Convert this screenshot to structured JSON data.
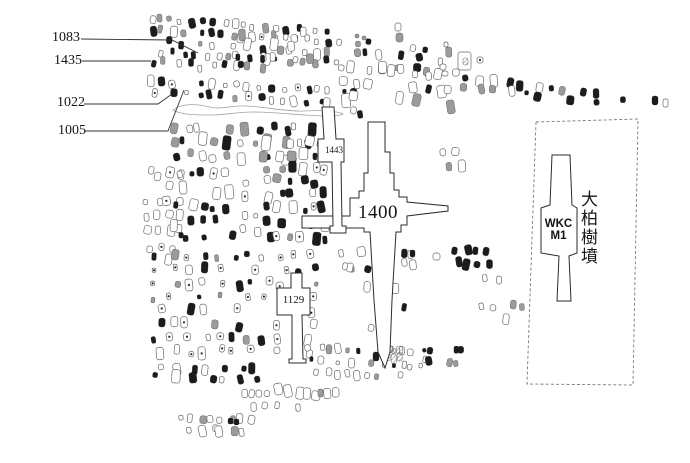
{
  "figure": {
    "type": "archaeological-cemetery-plan",
    "background": "#ffffff"
  },
  "labels": {
    "m1083": "1083",
    "m1435": "1435",
    "m1022": "1022",
    "m1005": "1005",
    "m1443": "1443",
    "m1400": "1400",
    "m1129": "1129",
    "wkc_line1": "WKC",
    "wkc_line2": "M1",
    "site_name": "大柏樹墳"
  },
  "colors": {
    "ink": "#1c1c1c",
    "open_stroke": "#686868",
    "gray_fill": "#9b9b9b",
    "hatch_stroke": "#777777",
    "tomb_stroke": "#2b2b2b",
    "leader": "#333333",
    "enclosure_dash": "#7a7a7a",
    "ditch": "#a3a3a3",
    "background": "#ffffff"
  },
  "geometry": {
    "tombs": [
      {
        "id": "1400",
        "points": "368,122 385,122 385,152 390,152 390,173 394,173 394,190 399,190 399,197 407,197 407,202 448,206 448,211 407,216 407,225 401,225 401,232 396,232 392,300 390,352 385,368 378,352 374,300 370,232 364,232 364,228 302,228 302,216 350,216 350,198 359,198 359,191 364,191 364,173 368,173"
      },
      {
        "id": "1443",
        "points": "322,107 334,107 336,139 344,139 344,162 341,162 342,226 346,226 346,233 330,233 330,226 333,226 332,162 318,162 318,139 324,139"
      },
      {
        "id": "1129",
        "points": "291,273 302,273 302,288 310,288 310,315 302,315 303,359 306,359 306,363 289,363 289,359 292,359 292,315 277,315 277,288 291,288"
      },
      {
        "id": "wkc-m1",
        "points": "552,155 570,155 572,205 577,208 577,253 569,256 571,301 557,301 559,256 541,253 541,208 550,205"
      }
    ],
    "enclosure": {
      "points": "536,122 638,119 633,385 527,384"
    },
    "leaders": [
      {
        "id": "1083",
        "points": "81,39 172,40 198,53"
      },
      {
        "id": "1435",
        "points": "82,61 151,61"
      },
      {
        "id": "1022",
        "points": "84,104 158,104 172,94"
      },
      {
        "id": "1005",
        "points": "85,131 168,131 184,90"
      }
    ],
    "ditch_path": "M173,110 C180,104 194,103 210,107 C221,110 231,105 247,106 C267,107 287,112 305,111 C321,110 337,111 343,114 C337,117 321,116 305,115 C289,114 271,112 253,112 C237,112 225,115 211,115 C197,115 181,115 173,110 Z",
    "scatter_regions": [
      {
        "id": "top-row-1",
        "x": 146,
        "y": 14,
        "w": 186,
        "h": 20,
        "rows": 2,
        "n": 18,
        "angle": 4,
        "skip": 0.08,
        "styles": {
          "solid": 0.32,
          "open": 0.38,
          "gray": 0.2,
          "dotted": 0.1
        },
        "sz": [
          3.5,
          7
        ]
      },
      {
        "id": "top-row-2",
        "x": 150,
        "y": 36,
        "w": 175,
        "h": 20,
        "rows": 2,
        "n": 13,
        "angle": 4,
        "skip": 0.15,
        "styles": {
          "solid": 0.35,
          "open": 0.45,
          "gray": 0.2
        },
        "sz": [
          3.5,
          7
        ]
      },
      {
        "id": "top-right-rows",
        "x": 238,
        "y": 27,
        "w": 215,
        "h": 32,
        "rows": 3,
        "n": 14,
        "angle": 5,
        "skip": 0.2,
        "styles": {
          "solid": 0.18,
          "open": 0.62,
          "gray": 0.2
        },
        "sz": [
          4,
          8
        ]
      },
      {
        "id": "row-1435",
        "x": 148,
        "y": 55,
        "w": 92,
        "h": 14,
        "rows": 1,
        "n": 8,
        "angle": 4,
        "skip": 0.12,
        "styles": {
          "solid": 0.5,
          "open": 0.4,
          "gray": 0.1
        },
        "sz": [
          3.5,
          7
        ]
      },
      {
        "id": "dark-cluster-mid",
        "x": 222,
        "y": 53,
        "w": 46,
        "h": 16,
        "rows": 2,
        "n": 4,
        "angle": 3,
        "skip": 0.1,
        "styles": {
          "solid": 0.75,
          "gray": 0.25
        },
        "sz": [
          4,
          7
        ]
      },
      {
        "id": "dense-row-1005",
        "x": 146,
        "y": 76,
        "w": 214,
        "h": 22,
        "rows": 2,
        "n": 18,
        "angle": 3,
        "skip": 0.08,
        "styles": {
          "solid": 0.45,
          "open": 0.3,
          "gray": 0.15,
          "dotted": 0.1
        },
        "sz": [
          3.5,
          7
        ]
      },
      {
        "id": "open-rows-right",
        "x": 336,
        "y": 60,
        "w": 122,
        "h": 44,
        "rows": 3,
        "n": 10,
        "angle": 4,
        "skip": 0.2,
        "styles": {
          "solid": 0.08,
          "open": 0.77,
          "gray": 0.15
        },
        "sz": [
          4.5,
          9
        ]
      },
      {
        "id": "far-east-row",
        "x": 458,
        "y": 74,
        "w": 186,
        "h": 16,
        "rows": 2,
        "n": 13,
        "angle": 7,
        "skip": 0.22,
        "styles": {
          "solid": 0.55,
          "open": 0.25,
          "gray": 0.2
        },
        "sz": [
          4,
          8
        ]
      },
      {
        "id": "field-top",
        "x": 166,
        "y": 120,
        "w": 152,
        "h": 42,
        "rows": 3,
        "n": 11,
        "angle": 1,
        "skip": 0.15,
        "styles": {
          "solid": 0.5,
          "open": 0.3,
          "gray": 0.2
        },
        "sz": [
          4,
          8.5
        ]
      },
      {
        "id": "rounded-cluster",
        "x": 258,
        "y": 137,
        "w": 72,
        "h": 25,
        "rows": 2,
        "n": 5,
        "angle": 0,
        "skip": 0.15,
        "styles": {
          "open": 0.8,
          "gray": 0.2
        },
        "sz": [
          6,
          10
        ]
      },
      {
        "id": "left-light-column",
        "x": 143,
        "y": 166,
        "w": 42,
        "h": 102,
        "rows": 7,
        "n": 4,
        "angle": 0,
        "skip": 0.2,
        "styles": {
          "open": 0.85,
          "dotted": 0.15
        },
        "sz": [
          4.5,
          8.5
        ]
      },
      {
        "id": "field-mid-left",
        "x": 170,
        "y": 166,
        "w": 66,
        "h": 80,
        "rows": 5,
        "n": 5,
        "angle": 0,
        "skip": 0.12,
        "styles": {
          "solid": 0.5,
          "open": 0.25,
          "dotted": 0.15,
          "gray": 0.1
        },
        "sz": [
          4,
          8.5
        ]
      },
      {
        "id": "field-mid-gap",
        "x": 240,
        "y": 172,
        "w": 20,
        "h": 68,
        "rows": 4,
        "n": 2,
        "angle": 0,
        "skip": 0.3,
        "styles": {
          "open": 0.8,
          "dotted": 0.2
        },
        "sz": [
          4,
          7
        ]
      },
      {
        "id": "field-mid-right",
        "x": 262,
        "y": 160,
        "w": 68,
        "h": 84,
        "rows": 6,
        "n": 6,
        "angle": 0,
        "skip": 0.15,
        "styles": {
          "solid": 0.5,
          "open": 0.25,
          "dotted": 0.15,
          "gray": 0.1
        },
        "sz": [
          4,
          8.5
        ]
      },
      {
        "id": "field-lower",
        "x": 150,
        "y": 250,
        "w": 170,
        "h": 108,
        "rows": 8,
        "n": 11,
        "angle": 0,
        "skip": 0.15,
        "styles": {
          "solid": 0.3,
          "open": 0.2,
          "dotted": 0.4,
          "gray": 0.1
        },
        "sz": [
          3.5,
          7.5
        ]
      },
      {
        "id": "field-bottom-dark",
        "x": 152,
        "y": 362,
        "w": 112,
        "h": 18,
        "rows": 2,
        "n": 7,
        "angle": 2,
        "skip": 0.2,
        "styles": {
          "solid": 0.65,
          "open": 0.35
        },
        "sz": [
          4.5,
          8.5
        ]
      },
      {
        "id": "bottom-oval-row",
        "x": 238,
        "y": 384,
        "w": 100,
        "h": 13,
        "rows": 1,
        "n": 11,
        "angle": 2,
        "skip": 0.1,
        "styles": {
          "open": 0.92,
          "gray": 0.08
        },
        "sz": [
          4.5,
          8.5
        ]
      },
      {
        "id": "bottom-oval-row-2",
        "x": 245,
        "y": 400,
        "w": 58,
        "h": 11,
        "rows": 1,
        "n": 5,
        "angle": 0,
        "skip": 0.1,
        "styles": {
          "open": 1
        },
        "sz": [
          4,
          7.5
        ]
      },
      {
        "id": "bottom-left-light",
        "x": 176,
        "y": 410,
        "w": 82,
        "h": 24,
        "rows": 2,
        "n": 8,
        "angle": 3,
        "skip": 0.15,
        "styles": {
          "open": 0.95,
          "gray": 0.05
        },
        "sz": [
          4,
          7.5
        ]
      },
      {
        "id": "center-upper",
        "x": 338,
        "y": 243,
        "w": 60,
        "h": 52,
        "rows": 3,
        "n": 3,
        "angle": 0,
        "skip": 0.35,
        "styles": {
          "open": 0.65,
          "solid": 0.25,
          "gray": 0.1
        },
        "sz": [
          4,
          8
        ]
      },
      {
        "id": "center-lower",
        "x": 340,
        "y": 300,
        "w": 75,
        "h": 38,
        "rows": 2,
        "n": 3,
        "angle": 0,
        "skip": 0.4,
        "styles": {
          "open": 0.7,
          "solid": 0.3
        },
        "sz": [
          4,
          8
        ]
      },
      {
        "id": "tip-band",
        "x": 306,
        "y": 340,
        "w": 120,
        "h": 26,
        "rows": 2,
        "n": 12,
        "angle": 3,
        "skip": 0.2,
        "styles": {
          "open": 0.5,
          "solid": 0.3,
          "gray": 0.2
        },
        "sz": [
          3,
          6.5
        ]
      },
      {
        "id": "tip-light-row",
        "x": 310,
        "y": 367,
        "w": 96,
        "h": 11,
        "rows": 1,
        "n": 9,
        "angle": 2,
        "skip": 0.15,
        "styles": {
          "open": 0.9,
          "gray": 0.1
        },
        "sz": [
          3.5,
          6.5
        ]
      },
      {
        "id": "east-dark-cluster",
        "x": 450,
        "y": 246,
        "w": 44,
        "h": 22,
        "rows": 2,
        "n": 4,
        "angle": 0,
        "skip": 0.1,
        "styles": {
          "solid": 0.6,
          "gray": 0.2,
          "hatch": 0.2
        },
        "sz": [
          5,
          8.5
        ]
      },
      {
        "id": "east-small-opens",
        "x": 481,
        "y": 273,
        "w": 20,
        "h": 12,
        "rows": 1,
        "n": 3,
        "angle": 0,
        "skip": 0.1,
        "styles": {
          "open": 1
        },
        "sz": [
          4,
          6
        ]
      },
      {
        "id": "east-open-row",
        "x": 478,
        "y": 299,
        "w": 46,
        "h": 12,
        "rows": 1,
        "n": 5,
        "angle": 3,
        "skip": 0.15,
        "styles": {
          "open": 0.85,
          "gray": 0.15
        },
        "sz": [
          4,
          7
        ]
      },
      {
        "id": "east-dark-trio",
        "x": 497,
        "y": 312,
        "w": 22,
        "h": 12,
        "rows": 1,
        "n": 3,
        "angle": 0,
        "skip": 0,
        "styles": {
          "solid": 0.8,
          "open": 0.2
        },
        "sz": [
          4.5,
          7.5
        ]
      },
      {
        "id": "under-arm-cluster",
        "x": 426,
        "y": 148,
        "w": 38,
        "h": 24,
        "rows": 2,
        "n": 3,
        "angle": 0,
        "skip": 0.2,
        "styles": {
          "gray": 0.4,
          "open": 0.6
        },
        "sz": [
          5,
          9
        ]
      },
      {
        "id": "tip-hatch",
        "x": 386,
        "y": 346,
        "w": 18,
        "h": 15,
        "rows": 2,
        "n": 3,
        "angle": 0,
        "skip": 0.1,
        "styles": {
          "hatch": 1
        },
        "sz": [
          4,
          6.5
        ]
      },
      {
        "id": "trio-open",
        "x": 333,
        "y": 263,
        "w": 22,
        "h": 11,
        "rows": 1,
        "n": 3,
        "angle": 0,
        "skip": 0,
        "styles": {
          "open": 1
        },
        "sz": [
          4,
          6
        ]
      },
      {
        "id": "below-east-arm",
        "x": 398,
        "y": 249,
        "w": 18,
        "h": 20,
        "rows": 2,
        "n": 2,
        "angle": 0,
        "skip": 0.2,
        "styles": {
          "open": 0.8,
          "solid": 0.2
        },
        "sz": [
          4,
          7
        ]
      },
      {
        "id": "ditch-end-cluster",
        "x": 344,
        "y": 106,
        "w": 22,
        "h": 13,
        "rows": 1,
        "n": 3,
        "angle": 3,
        "skip": 0.2,
        "styles": {
          "solid": 0.5,
          "open": 0.5
        },
        "sz": [
          4,
          7
        ]
      },
      {
        "id": "se-dark-row",
        "x": 438,
        "y": 342,
        "w": 28,
        "h": 11,
        "rows": 1,
        "n": 4,
        "angle": 0,
        "skip": 0,
        "styles": {
          "solid": 0.6,
          "open": 0.4
        },
        "sz": [
          4,
          7.5
        ]
      },
      {
        "id": "se-open-cluster",
        "x": 419,
        "y": 345,
        "w": 15,
        "h": 22,
        "rows": 2,
        "n": 2,
        "angle": 0,
        "skip": 0,
        "styles": {
          "open": 0.7,
          "solid": 0.3
        },
        "sz": [
          4,
          7.5
        ]
      },
      {
        "id": "se-gray-pair",
        "x": 447,
        "y": 359,
        "w": 12,
        "h": 8,
        "rows": 1,
        "n": 2,
        "angle": 0,
        "skip": 0,
        "styles": {
          "gray": 1
        },
        "sz": [
          4,
          6
        ]
      }
    ],
    "single_marks": [
      {
        "x": 395,
        "y": 23,
        "w": 6,
        "h": 8,
        "style": "open"
      },
      {
        "x": 396,
        "y": 33,
        "w": 7,
        "h": 9,
        "style": "gray"
      },
      {
        "x": 444,
        "y": 42,
        "w": 4,
        "h": 5,
        "style": "open"
      },
      {
        "x": 458,
        "y": 52,
        "w": 13,
        "h": 18,
        "style": "open"
      },
      {
        "x": 463,
        "y": 58,
        "w": 5,
        "h": 7,
        "style": "hatch"
      },
      {
        "x": 477,
        "y": 57,
        "w": 6,
        "h": 6,
        "style": "dotted"
      },
      {
        "x": 440,
        "y": 64,
        "w": 6,
        "h": 6,
        "style": "open"
      },
      {
        "x": 442,
        "y": 71,
        "w": 6,
        "h": 5,
        "style": "open"
      },
      {
        "x": 652,
        "y": 96,
        "w": 6,
        "h": 9,
        "style": "solid"
      },
      {
        "x": 663,
        "y": 99,
        "w": 5,
        "h": 8,
        "style": "open"
      },
      {
        "x": 228,
        "y": 418,
        "w": 5,
        "h": 6,
        "style": "solid"
      },
      {
        "x": 234,
        "y": 419,
        "w": 5,
        "h": 6,
        "style": "solid"
      },
      {
        "x": 433,
        "y": 253,
        "w": 7,
        "h": 7,
        "style": "open"
      },
      {
        "x": 410,
        "y": 250,
        "w": 5,
        "h": 7,
        "style": "solid"
      },
      {
        "x": 373,
        "y": 352,
        "w": 6,
        "h": 9,
        "style": "solid"
      },
      {
        "x": 355,
        "y": 34,
        "w": 4,
        "h": 4,
        "style": "gray"
      },
      {
        "x": 362,
        "y": 36,
        "w": 4,
        "h": 4,
        "style": "gray"
      },
      {
        "x": 318,
        "y": 389,
        "w": 5,
        "h": 8,
        "style": "gray"
      }
    ]
  }
}
